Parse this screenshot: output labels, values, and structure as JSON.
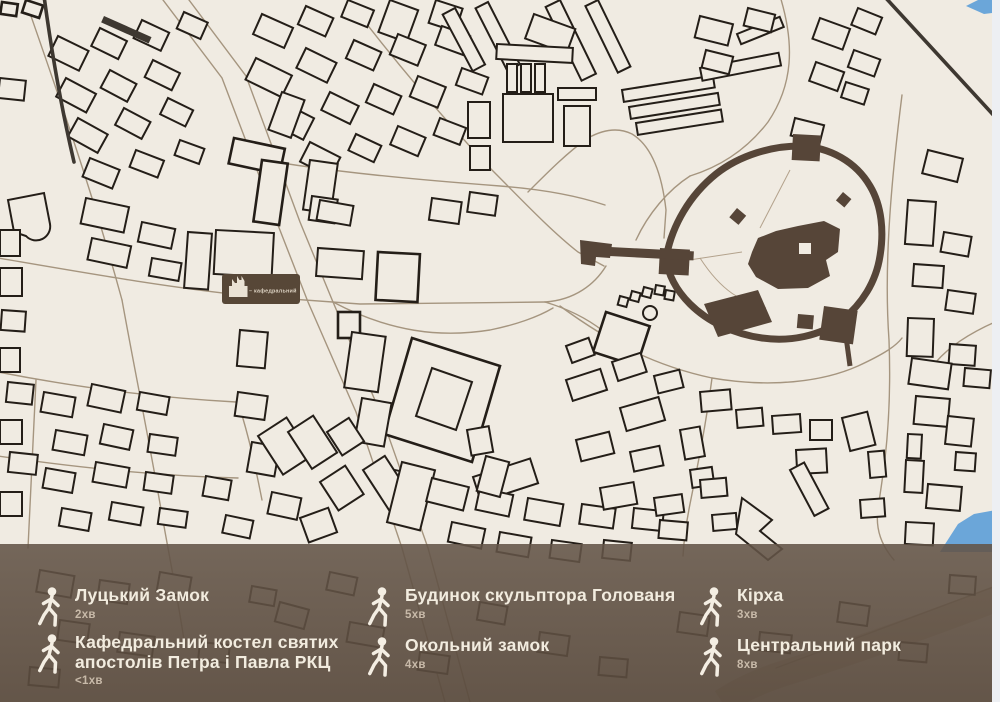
{
  "map": {
    "marker": {
      "label": "– кафедральний"
    },
    "colors": {
      "background": "#f0ebe2",
      "building_outline": "#241e18",
      "road": "#a5957f",
      "castle_brown": "#564538",
      "water_blue": "#6ba6d9",
      "overlay_brown": "#63544a",
      "legend_title": "#f2ecdf",
      "legend_time": "#c8baa9"
    }
  },
  "legend": {
    "items": [
      {
        "title": "Луцький Замок",
        "time": "2хв"
      },
      {
        "title": "Кафедральний костел святих",
        "title2": "апостолів Петра і Павла РКЦ",
        "time": "<1хв"
      },
      {
        "title": "Будинок скульптора Голованя",
        "time": "5хв"
      },
      {
        "title": "Окольний замок",
        "time": "4хв"
      },
      {
        "title": "Кірха",
        "time": "3хв"
      },
      {
        "title": "Центральний парк",
        "time": "8хв"
      }
    ]
  }
}
